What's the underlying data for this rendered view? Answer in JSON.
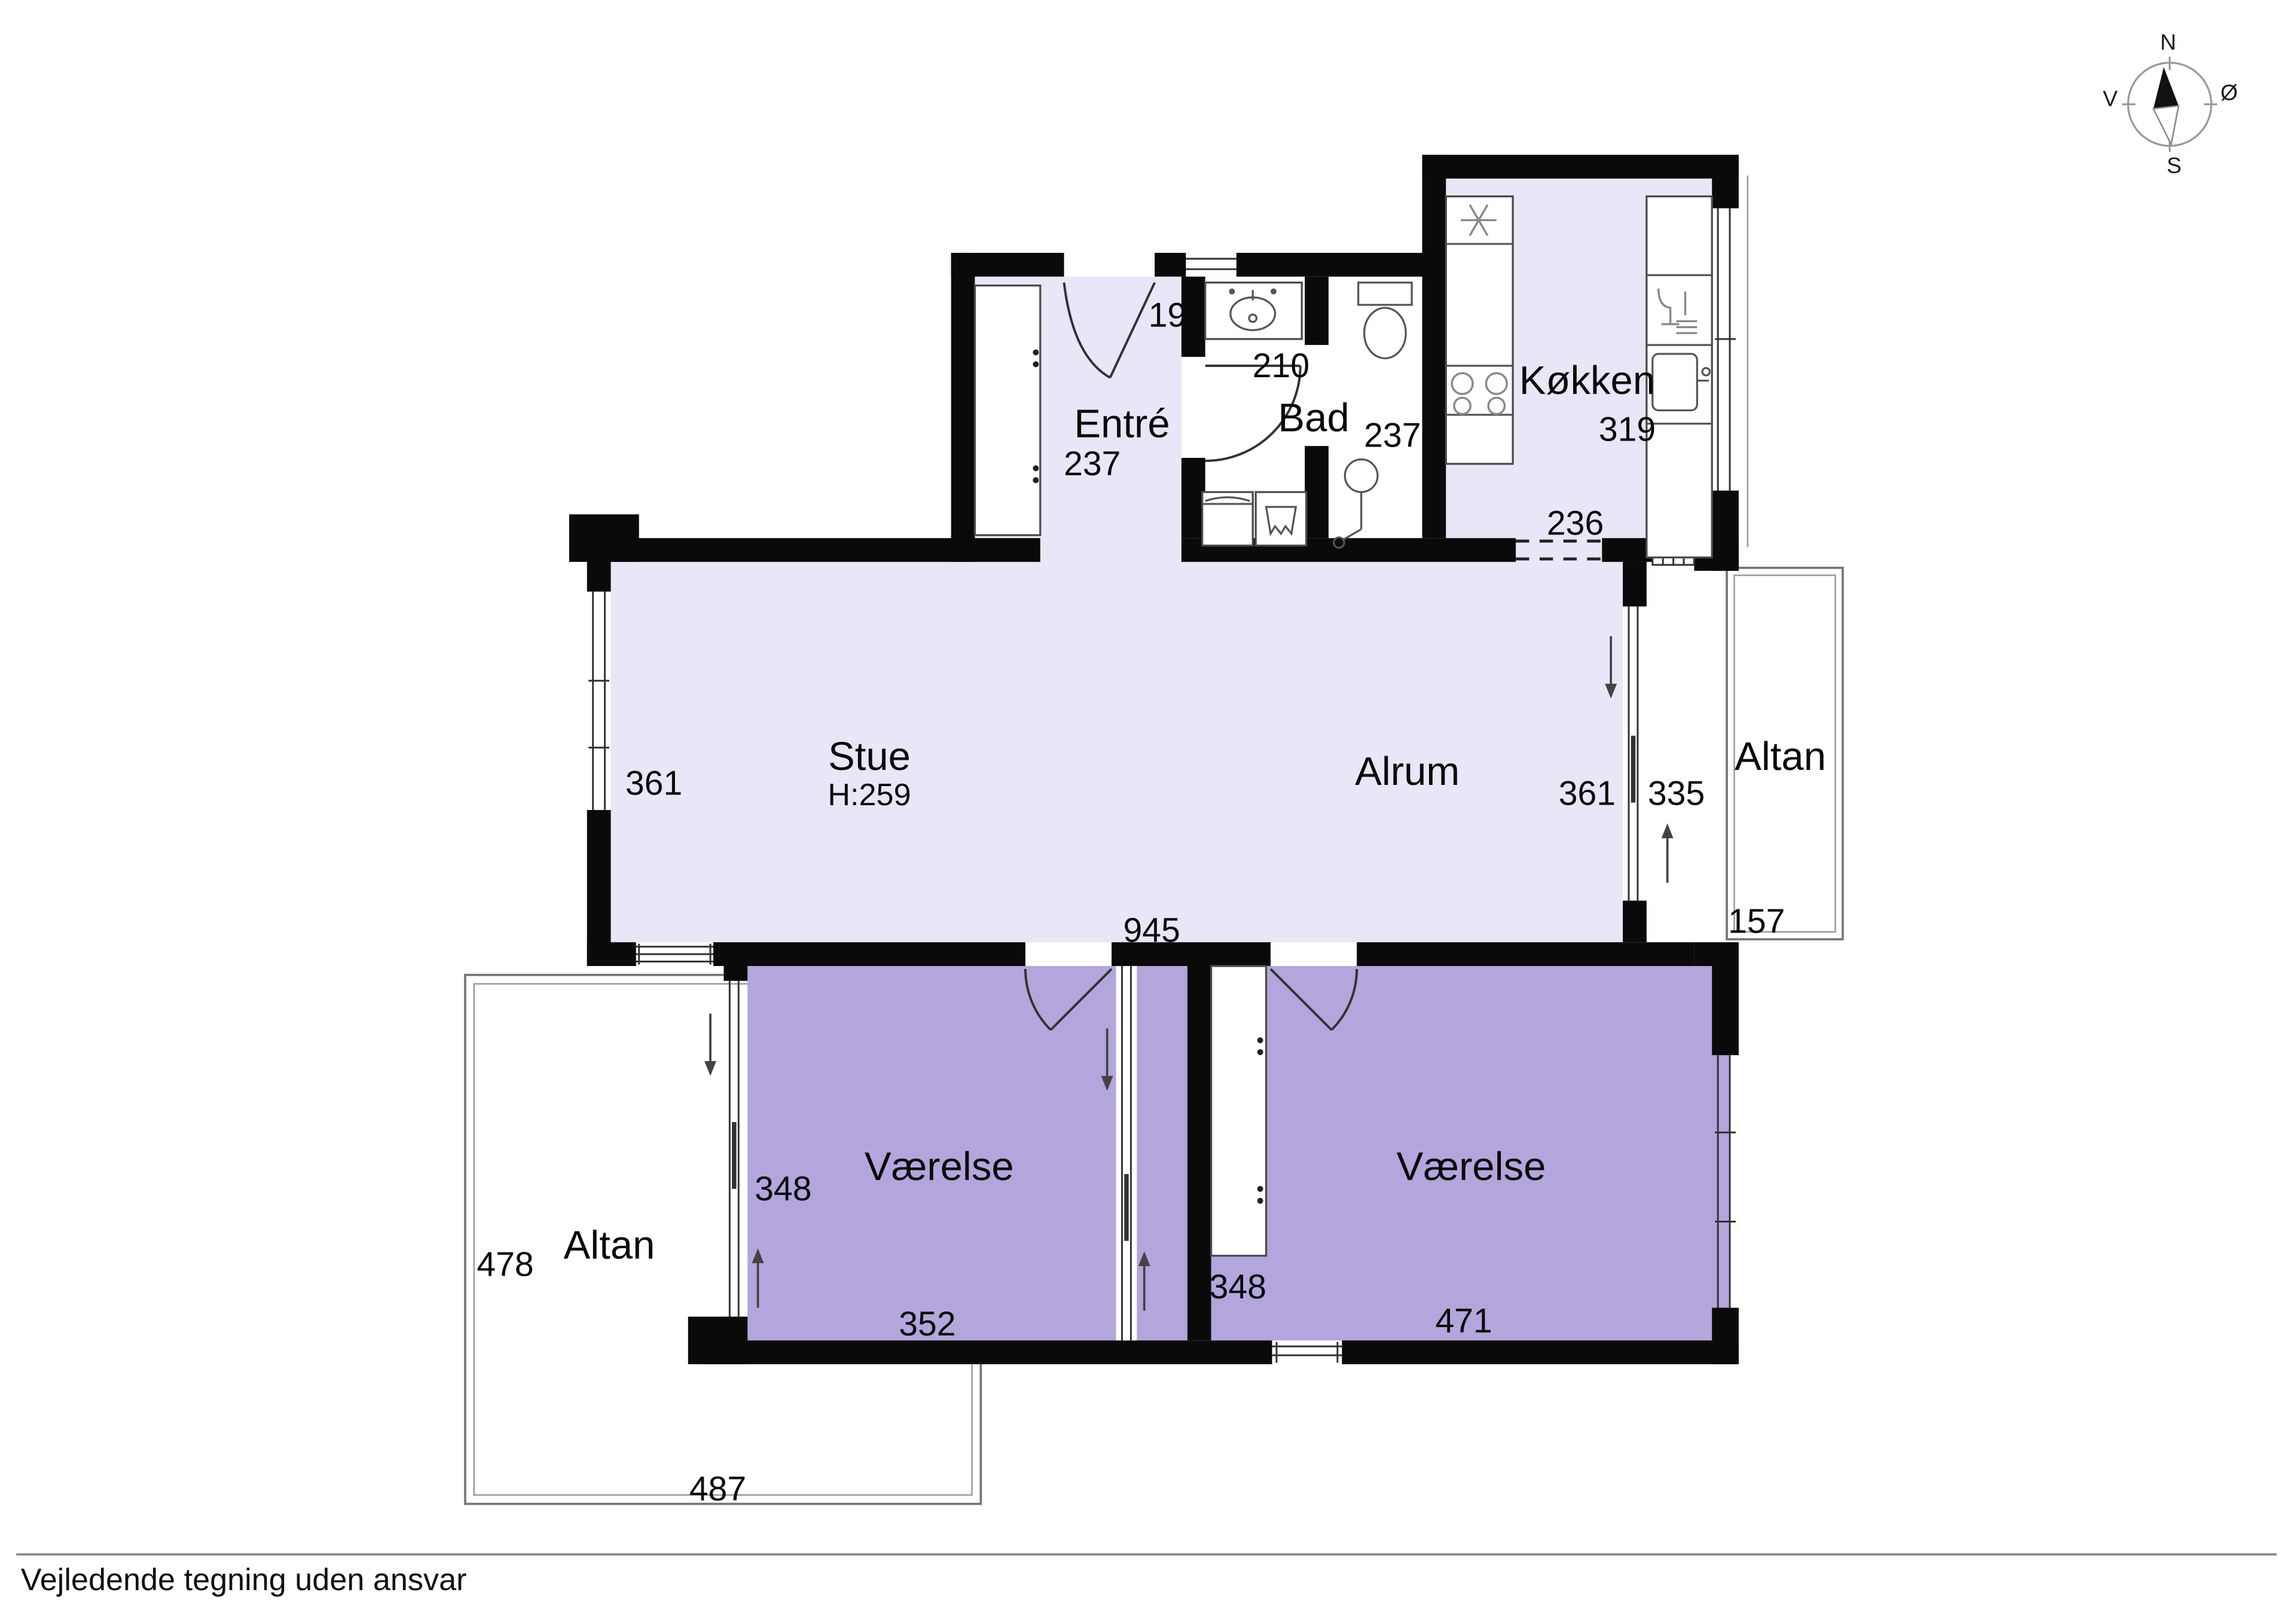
{
  "footer": {
    "disclaimer": "Vejledende tegning uden ansvar"
  },
  "compass": {
    "north": "N",
    "east": "Ø",
    "south": "S",
    "west": "V"
  },
  "rooms": {
    "entre": {
      "name": "Entré",
      "door_width": "199",
      "depth": "237"
    },
    "bad": {
      "name": "Bad",
      "counter_width": "210",
      "depth": "237"
    },
    "kokken": {
      "name": "Køkken",
      "depth": "319",
      "width": "236"
    },
    "stue": {
      "name": "Stue",
      "ceiling_height": "H:259",
      "depth": "361"
    },
    "alrum": {
      "name": "Alrum",
      "depth": "361",
      "combined_width": "945"
    },
    "altan_east": {
      "name": "Altan",
      "depth": "335",
      "width": "157"
    },
    "vaerelse_west": {
      "name": "Værelse",
      "depth": "348",
      "width": "352"
    },
    "vaerelse_east": {
      "name": "Værelse",
      "closet_depth": "348",
      "width": "471"
    },
    "altan_west": {
      "name": "Altan",
      "depth": "478",
      "width": "487"
    }
  },
  "colors": {
    "floor_light": "#e9e6f8",
    "floor_bedroom": "#b3a6dc",
    "wall": "#0a0a0a",
    "background": "#ffffff"
  }
}
